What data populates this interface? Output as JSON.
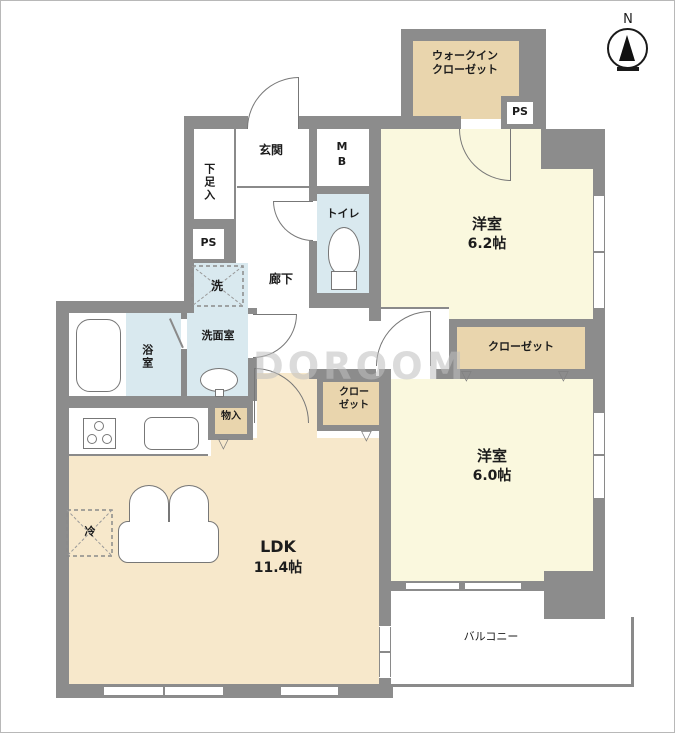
{
  "plan": {
    "compass": "N",
    "watermark": "DOROOM",
    "colors": {
      "wall": "#8c8c8c",
      "closet_tan": "#e9d5ad",
      "room_cream": "#faf8de",
      "wet_blue": "#d9e9ef",
      "ldk_tan": "#f7e8cb"
    },
    "rooms": {
      "wic_line1": "ウォークイン",
      "wic_line2": "クローゼット",
      "ps_top": "PS",
      "ps_left": "PS",
      "western1_name": "洋室",
      "western1_size": "6.2帖",
      "western2_name": "洋室",
      "western2_size": "6.0帖",
      "ldk_name": "LDK",
      "ldk_size": "11.4帖",
      "balcony": "バルコニー",
      "entrance": "玄関",
      "shoe_storage": "下足入",
      "meter_box": "MB",
      "toilet": "トイレ",
      "hallway": "廊下",
      "washer": "洗",
      "washroom": "洗面室",
      "bathroom": "浴室",
      "storage": "物入",
      "closet_wide": "クローゼット",
      "closet_small_line1": "クロー",
      "closet_small_line2": "ゼット",
      "fridge": "冷"
    }
  }
}
